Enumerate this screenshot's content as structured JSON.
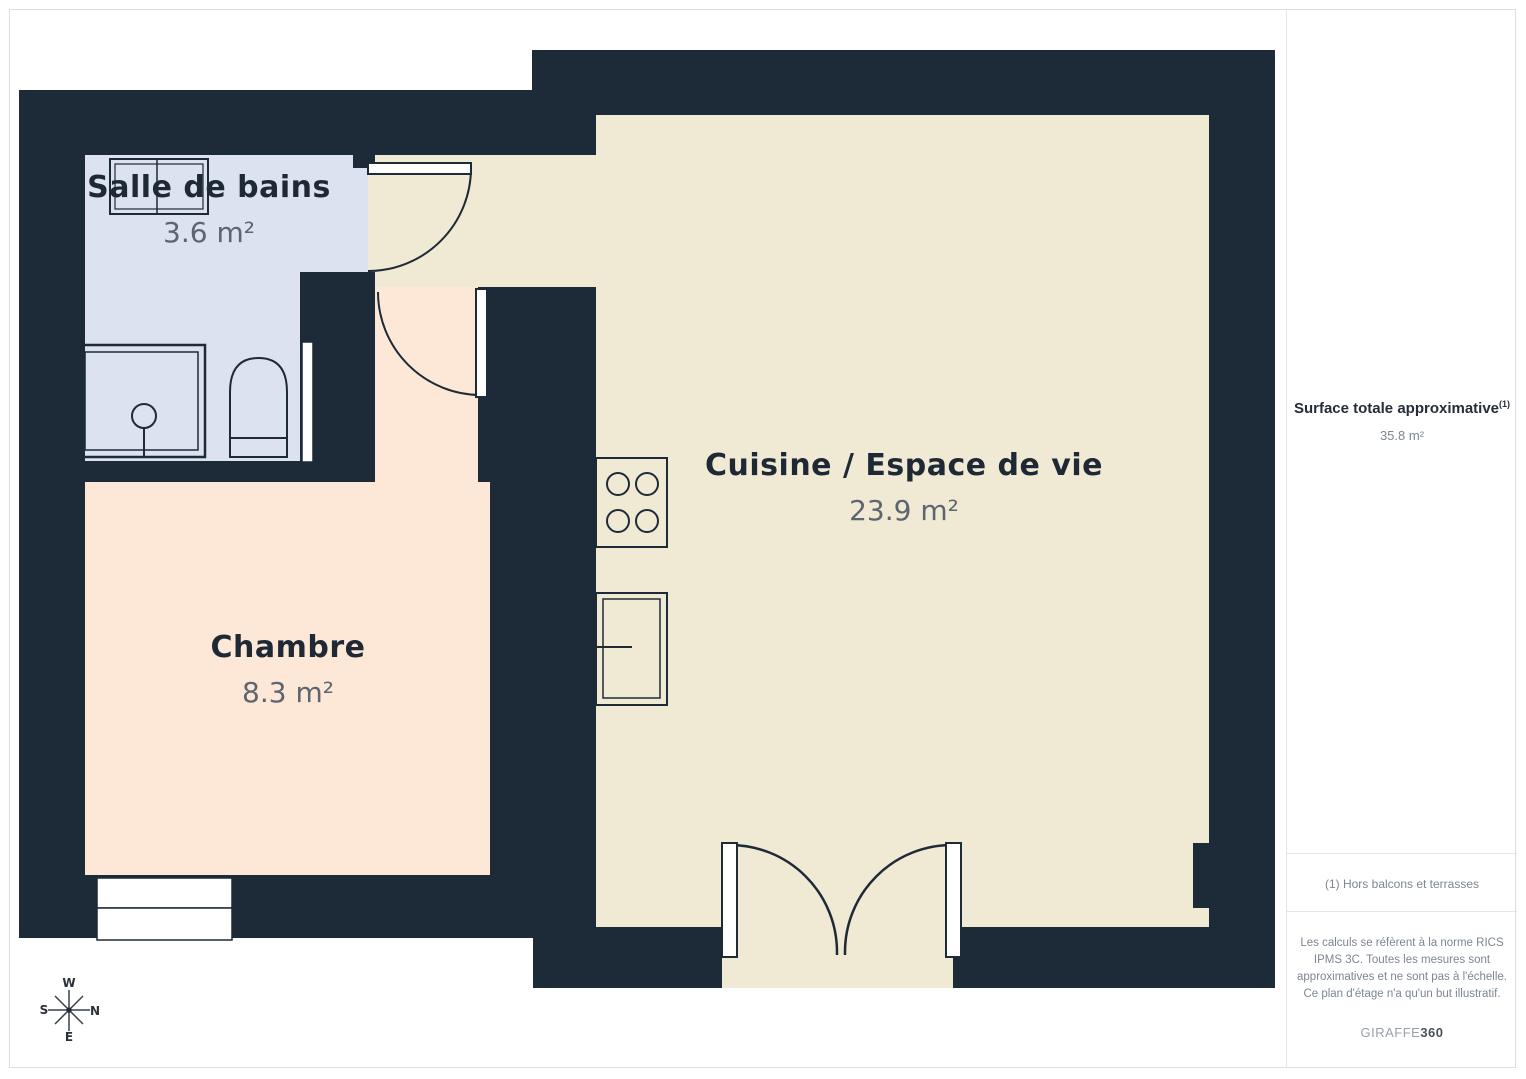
{
  "floorplan": {
    "rooms": [
      {
        "name": "Salle de bains",
        "area": "3.6 m²"
      },
      {
        "name": "Chambre",
        "area": "8.3 m²"
      },
      {
        "name": "Cuisine / Espace de vie",
        "area": "23.9 m²"
      }
    ],
    "compass": {
      "w": "W",
      "s": "S",
      "n": "N",
      "e": "E"
    },
    "colors": {
      "wall": "#1d2a38",
      "bathroom_floor": "#dce2f0",
      "bedroom_floor": "#fde8d7",
      "kitchen_floor": "#f0e9d4"
    }
  },
  "sidebar": {
    "surface_label": "Surface totale approximative",
    "surface_sup": "(1)",
    "surface_value": "35.8 m²",
    "footnote": "(1) Hors balcons et terrasses",
    "legal": "Les calculs se réfèrent à la norme RICS IPMS 3C. Toutes les mesures sont approximatives et ne sont pas à l'échelle. Ce plan d'étage n'a qu'un but illustratif.",
    "brand": {
      "name": "GIRAFFE",
      "suffix": "360"
    }
  }
}
